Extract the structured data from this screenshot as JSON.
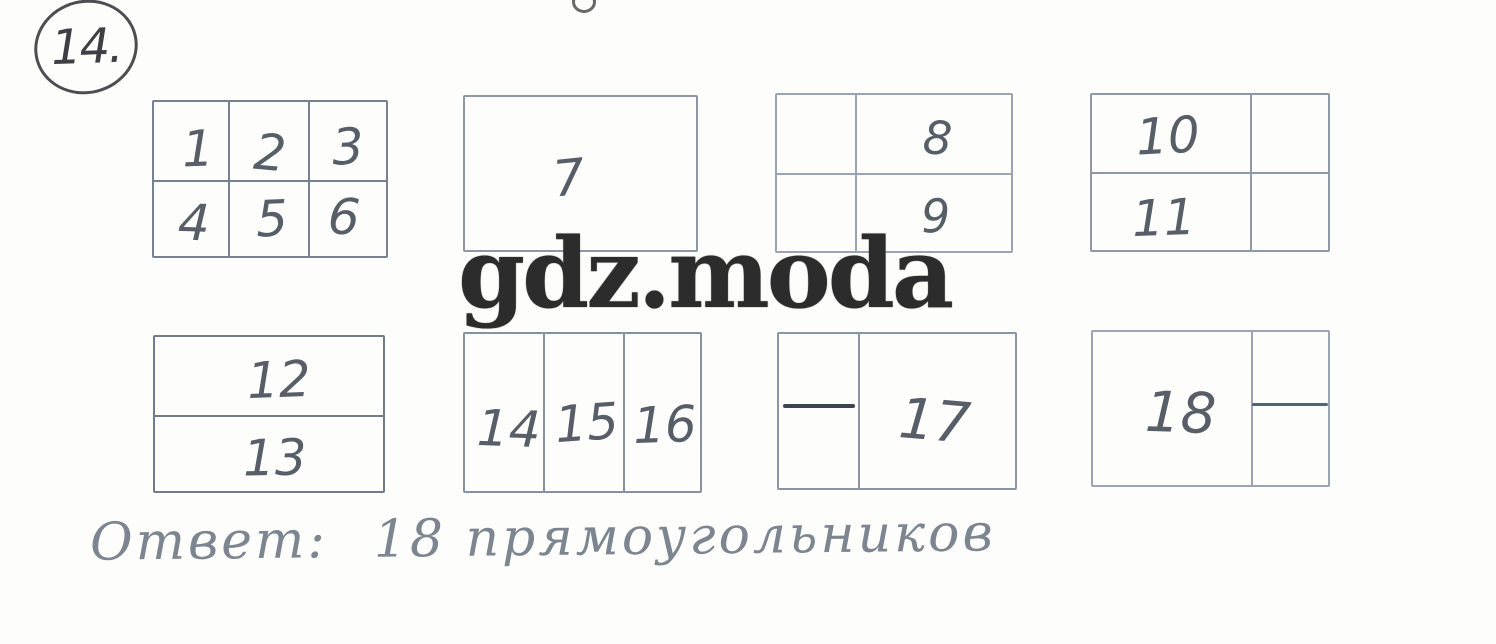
{
  "page": {
    "problem_number": "14.",
    "watermark_text": "gdz.moda",
    "answer": {
      "label": "Ответ:",
      "value": "18 прямоугольников"
    },
    "colors": {
      "paper": "#fdfdfc",
      "pencil_line": "#929cab",
      "pencil_digit": "#575e68",
      "watermark": "#2c2c2c",
      "answer_text": "#7c8590"
    }
  },
  "figures": [
    {
      "structure": "grid 2 rows x 3 columns",
      "cells": [
        "1",
        "2",
        "3",
        "4",
        "5",
        "6"
      ]
    },
    {
      "structure": "undivided rectangle",
      "cells": [
        "7"
      ]
    },
    {
      "structure": "horizontal split plus vertical line at left third",
      "cells": [
        "8",
        "9"
      ]
    },
    {
      "structure": "horizontal split plus vertical line at right third",
      "cells": [
        "10",
        "11"
      ]
    },
    {
      "structure": "horizontal split",
      "cells": [
        "12",
        "13"
      ]
    },
    {
      "structure": "three vertical columns",
      "cells": [
        "14",
        "15",
        "16"
      ]
    },
    {
      "structure": "vertical line at left third with half horizontal stroke in left column",
      "cells": [
        "17"
      ]
    },
    {
      "structure": "vertical line at right third with half horizontal stroke in right column",
      "cells": [
        "18"
      ]
    }
  ]
}
